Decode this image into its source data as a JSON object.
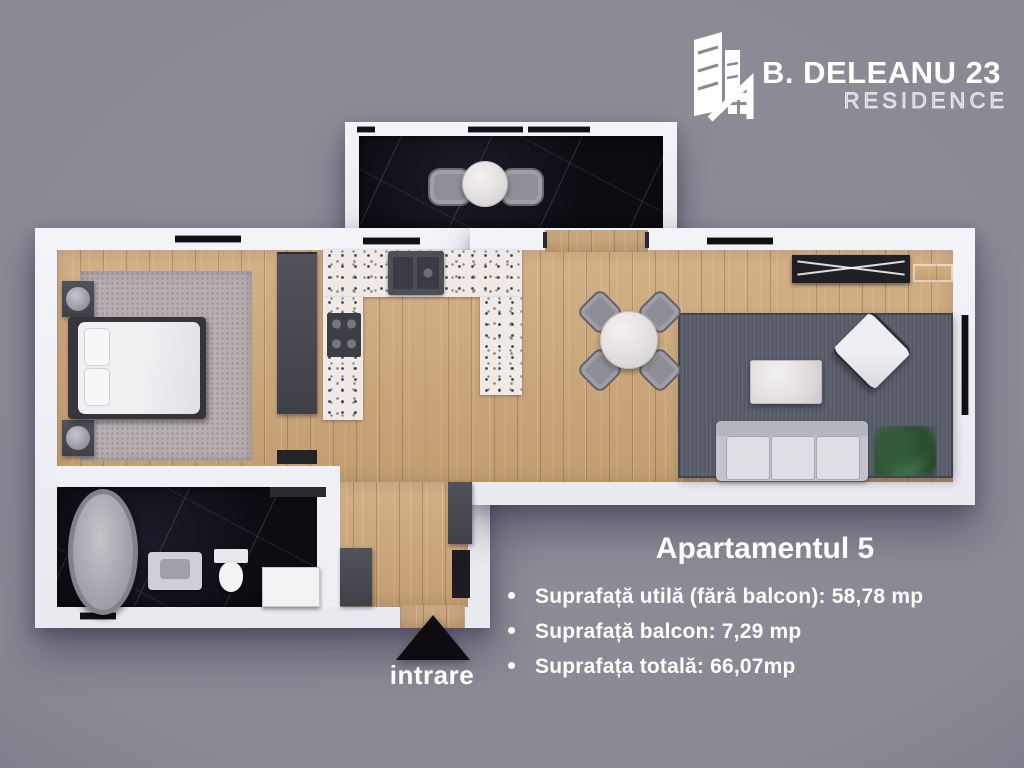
{
  "page": {
    "background_color": "#8b8793"
  },
  "logo": {
    "icon": "building-residence-icon",
    "title": "B. DELEANU 23",
    "subtitle": "RESIDENCE"
  },
  "floor_plan": {
    "entrance": {
      "label": "intrare",
      "icon": "entrance-arrow-icon"
    },
    "rooms": [
      "balcony",
      "living-dining",
      "kitchen",
      "hallway",
      "bedroom",
      "bathroom"
    ],
    "colors": {
      "wall": "#eef0f5",
      "wood_floor": "#cba97e",
      "dark_marble": "#0c0c12",
      "terrazzo_counter": "#efeae6",
      "living_rug": "#565b68",
      "bedroom_rug": "#b7afb2",
      "dark_furniture": "#47474d"
    }
  },
  "info_panel": {
    "title": "Apartamentul 5",
    "bullets": [
      "Suprafață utilă (fără balcon): 58,78 mp",
      "Suprafață balcon: 7,29 mp",
      "Suprafața totală: 66,07mp"
    ]
  }
}
